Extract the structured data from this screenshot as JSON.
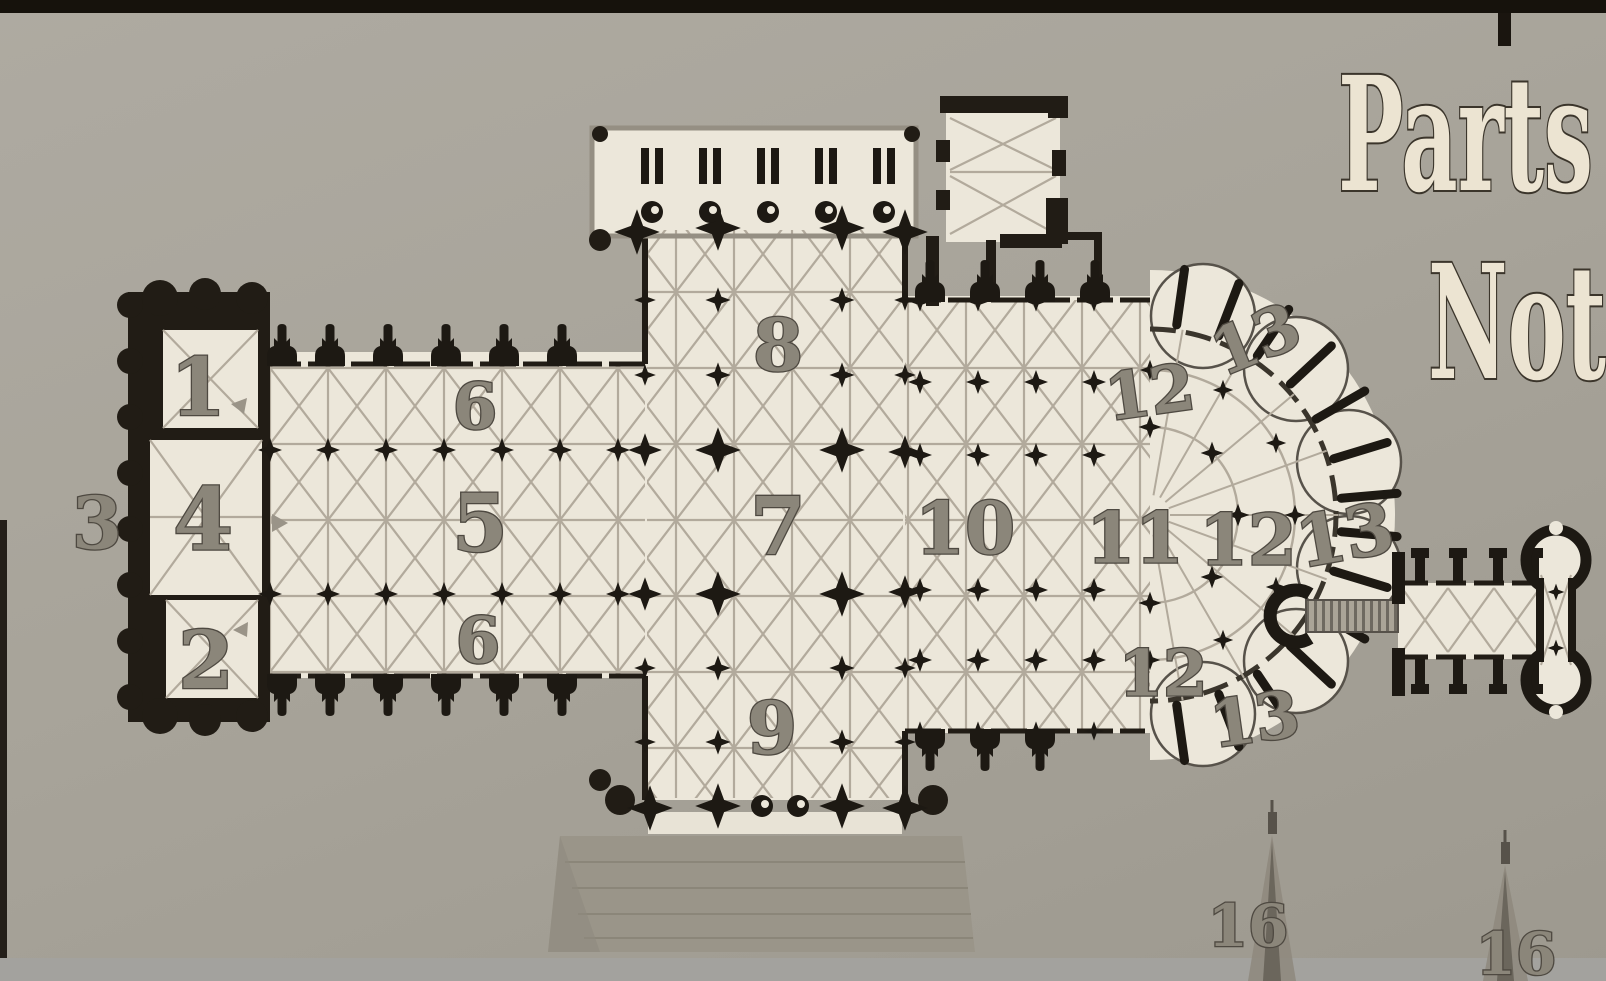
{
  "page": {
    "description": "Photographed textbook page: Gothic cathedral floor plan with numbered parts",
    "heading_line1": "Parts",
    "heading_line2": "Not"
  },
  "colors": {
    "background": "#a8a49a",
    "photo_frame": "#16120c",
    "plan_floor": "#ece7da",
    "vault_line": "#b2aa9c",
    "wall_black": "#211c15",
    "label_fill": "#8b867a",
    "label_stroke": "#4e4941",
    "heading_fill": "#ece4d2",
    "heading_stroke": "#3b352b",
    "porch_steps": "#9a9589",
    "spire_gray": "#8f8a7e"
  },
  "plan": {
    "name": "cathedral-floor-plan",
    "labels": [
      {
        "text": "1",
        "x": 198,
        "y": 387,
        "size": 80,
        "rot": 0
      },
      {
        "text": "2",
        "x": 206,
        "y": 660,
        "size": 80,
        "rot": 0
      },
      {
        "text": "3",
        "x": 97,
        "y": 523,
        "size": 72,
        "rot": 0
      },
      {
        "text": "4",
        "x": 203,
        "y": 520,
        "size": 86,
        "rot": 0
      },
      {
        "text": "5",
        "x": 480,
        "y": 523,
        "size": 80,
        "rot": 0
      },
      {
        "text": "6",
        "x": 475,
        "y": 407,
        "size": 64,
        "rot": 0
      },
      {
        "text": "6",
        "x": 478,
        "y": 641,
        "size": 64,
        "rot": 0
      },
      {
        "text": "7",
        "x": 778,
        "y": 526,
        "size": 80,
        "rot": 0
      },
      {
        "text": "8",
        "x": 778,
        "y": 345,
        "size": 72,
        "rot": 0
      },
      {
        "text": "9",
        "x": 772,
        "y": 728,
        "size": 72,
        "rot": 0
      },
      {
        "text": "10",
        "x": 965,
        "y": 528,
        "size": 72,
        "rot": 0
      },
      {
        "text": "11",
        "x": 1135,
        "y": 538,
        "size": 70,
        "rot": 0
      },
      {
        "text": "12",
        "x": 1150,
        "y": 393,
        "size": 64,
        "rot": -8
      },
      {
        "text": "12",
        "x": 1248,
        "y": 540,
        "size": 70,
        "rot": 0
      },
      {
        "text": "12",
        "x": 1163,
        "y": 674,
        "size": 64,
        "rot": 0
      },
      {
        "text": "13",
        "x": 1256,
        "y": 340,
        "size": 64,
        "rot": -22
      },
      {
        "text": "13",
        "x": 1345,
        "y": 535,
        "size": 70,
        "rot": -10
      },
      {
        "text": "13",
        "x": 1255,
        "y": 720,
        "size": 64,
        "rot": -8
      },
      {
        "text": "16",
        "x": 1248,
        "y": 926,
        "size": 58,
        "rot": 0
      },
      {
        "text": "16",
        "x": 1516,
        "y": 954,
        "size": 58,
        "rot": 0
      }
    ]
  }
}
